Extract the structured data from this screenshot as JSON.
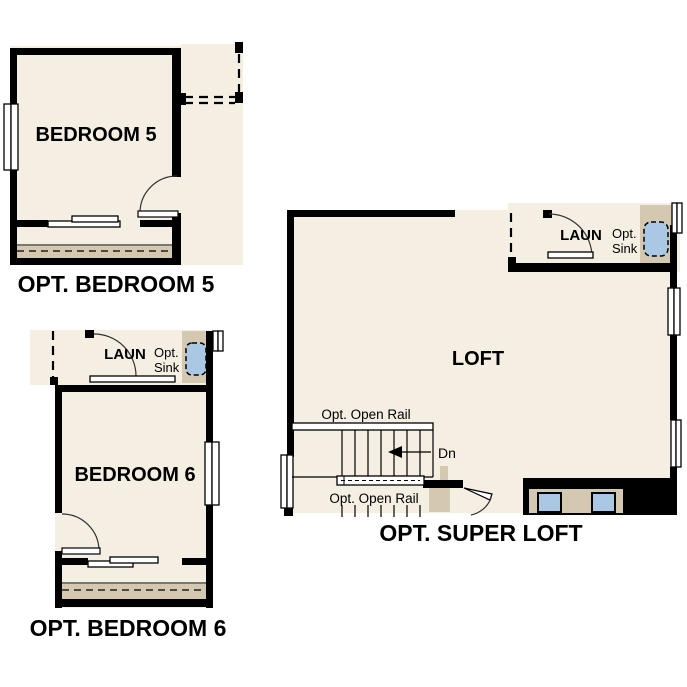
{
  "colors": {
    "background": "#ffffff",
    "floor": "#f5eee2",
    "cabinet_tan": "#d4c8b0",
    "fixture_blue": "#aac8e4",
    "wall": "#000000",
    "text": "#000000"
  },
  "plans": {
    "bedroom5": {
      "title": "OPT. BEDROOM 5",
      "room": "BEDROOM 5"
    },
    "bedroom6": {
      "title": "OPT. BEDROOM 6",
      "room": "BEDROOM 6",
      "laundry": "LAUN",
      "sink_line1": "Opt.",
      "sink_line2": "Sink"
    },
    "super_loft": {
      "title": "OPT. SUPER LOFT",
      "room": "LOFT",
      "laundry": "LAUN",
      "sink_line1": "Opt.",
      "sink_line2": "Sink",
      "rail_top": "Opt. Open Rail",
      "rail_bottom": "Opt. Open Rail",
      "down": "Dn"
    }
  }
}
